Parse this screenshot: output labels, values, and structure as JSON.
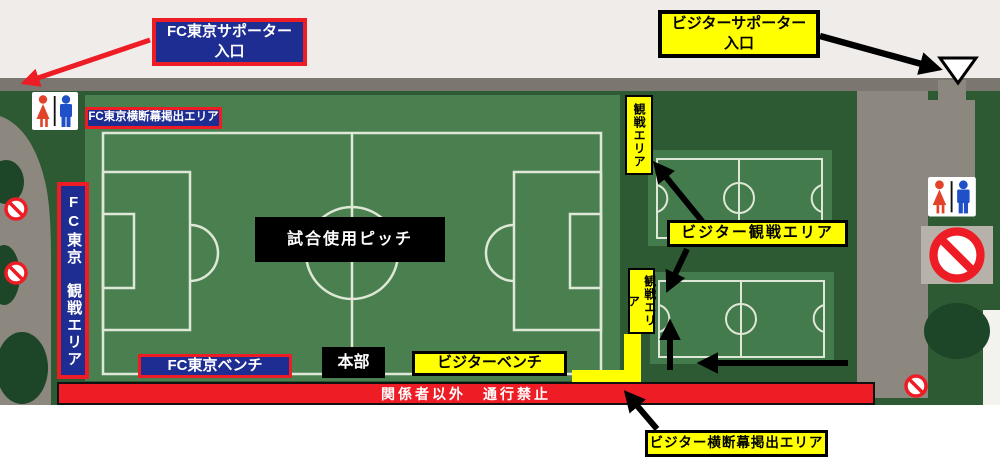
{
  "map": {
    "labels": {
      "fc_supporter_entrance": "FC東京サポーター\n入口",
      "visitor_supporter_entrance": "ビジターサポーター\n入口",
      "fc_banner_area": "FC東京横断幕掲出エリア",
      "fc_viewing_area": "FC東京　観戦エリア",
      "match_pitch": "試合使用ピッチ",
      "headquarters": "本部",
      "fc_bench": "FC東京ベンチ",
      "visitor_bench": "ビジターベンチ",
      "no_passage": "関係者以外　通行禁止",
      "visitor_viewing_area": "ビジター観戦エリア",
      "viewing_area_north": "観戦エリア",
      "viewing_area_south": "観戦エリア",
      "visitor_banner_area": "ビジター横断幕掲出エリア"
    },
    "icons": {
      "restroom_left": "restroom-icon",
      "restroom_right": "restroom-icon",
      "no_entry_left_upper": "no-entry-icon",
      "no_entry_left_lower": "no-entry-icon",
      "no_entry_right_large": "no-entry-icon",
      "no_entry_bottom_right": "no-entry-icon",
      "visitor_entrance_marker": "entrance-triangle-icon",
      "fc_entrance_arrow": "red-arrow-icon",
      "visitor_entrance_arrow": "black-arrow-icon",
      "flow_arrows": "black-arrow-icon"
    },
    "colors": {
      "accent_red": "#ee1c24",
      "deep_blue": "#1e2d92",
      "highlight_yellow": "#ffff00",
      "pitch_green": "#4a8050",
      "small_field_green": "#447b4c",
      "dark_green": "#2d5a33",
      "tree_green": "#1d4527",
      "path_gray": "#8d887f",
      "strip_gray": "#7b766f",
      "line_white": "#dfe8d6",
      "male_blue": "#2050c8",
      "female_red": "#e2422a",
      "black": "#000000",
      "white": "#ffffff"
    }
  }
}
